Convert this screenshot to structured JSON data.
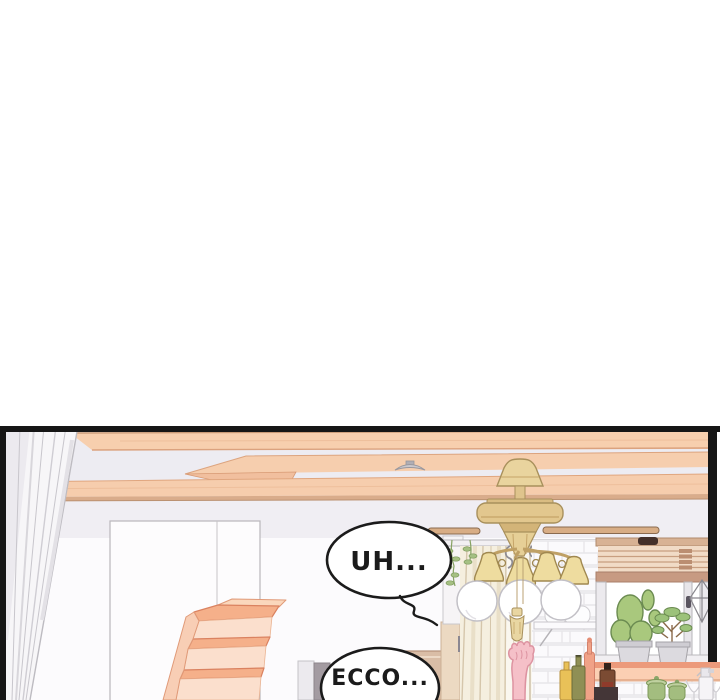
{
  "page": {
    "type": "comic-panel",
    "blank_top_area": true
  },
  "panel": {
    "speech_bubbles": [
      {
        "id": "bubble-uh",
        "text": "UH..."
      },
      {
        "id": "bubble-ecco",
        "text": "ECCO..."
      }
    ],
    "scene_objects": [
      "left-white-curtain",
      "ceiling-wood-planks",
      "ceiling-detector",
      "staircase-panel",
      "wooden-stairs",
      "ceiling-fan-lamp",
      "fan-blades",
      "glass-globes",
      "pull-tassel",
      "cream-curtain",
      "curtain-rail-hooks",
      "white-brick-wall",
      "wall-shelf",
      "window-blinds",
      "window-frame",
      "potted-cactus",
      "potted-plant",
      "hanging-terrarium",
      "kitchen-counter",
      "bottles",
      "green-jars",
      "spray-bottle",
      "pink-paw",
      "wood-cabinet",
      "hanging-sprigs"
    ],
    "colors": {
      "panel_border": "#161616",
      "wood_plank": "#f7cfae",
      "wood_edge": "#dba27e",
      "wall_gray": "#f0eef3",
      "wall_white": "#fcfbfd",
      "brass": "#e5cc92",
      "cream_curtain": "#f5efdf",
      "counter_salmon": "#ee9c7d",
      "blinds": "#f1dbc6",
      "plant_green": "#a9c87d",
      "stair_peach": "#f5b18c",
      "paw_pink": "#f5c0c8",
      "bubble_fill": "#ffffff",
      "bubble_stroke": "#1b1b1b"
    }
  }
}
